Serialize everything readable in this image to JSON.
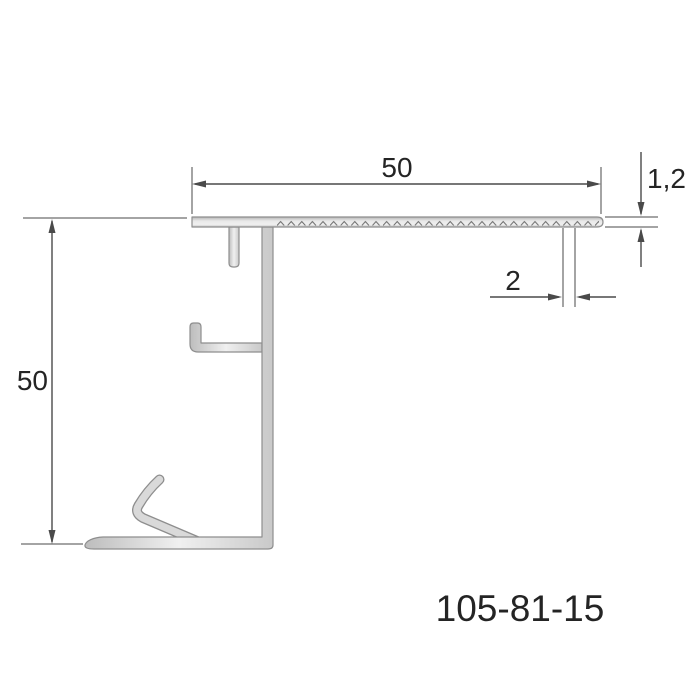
{
  "profile": {
    "part_number": "105-81-15"
  },
  "dimensions": {
    "top_width": "50",
    "height": "50",
    "thickness": "1,2",
    "slot": "2"
  },
  "colors": {
    "background": "#ffffff",
    "profile-outline": "#8e8e8e",
    "profile-fill-light": "#f0f0f0",
    "profile-fill-dark": "#bdbdbd",
    "profile-fill-edge": "#c9c9c9",
    "serration": "#6f6f6f",
    "dimension-line": "#4a4a4a",
    "text-color": "#242424"
  }
}
